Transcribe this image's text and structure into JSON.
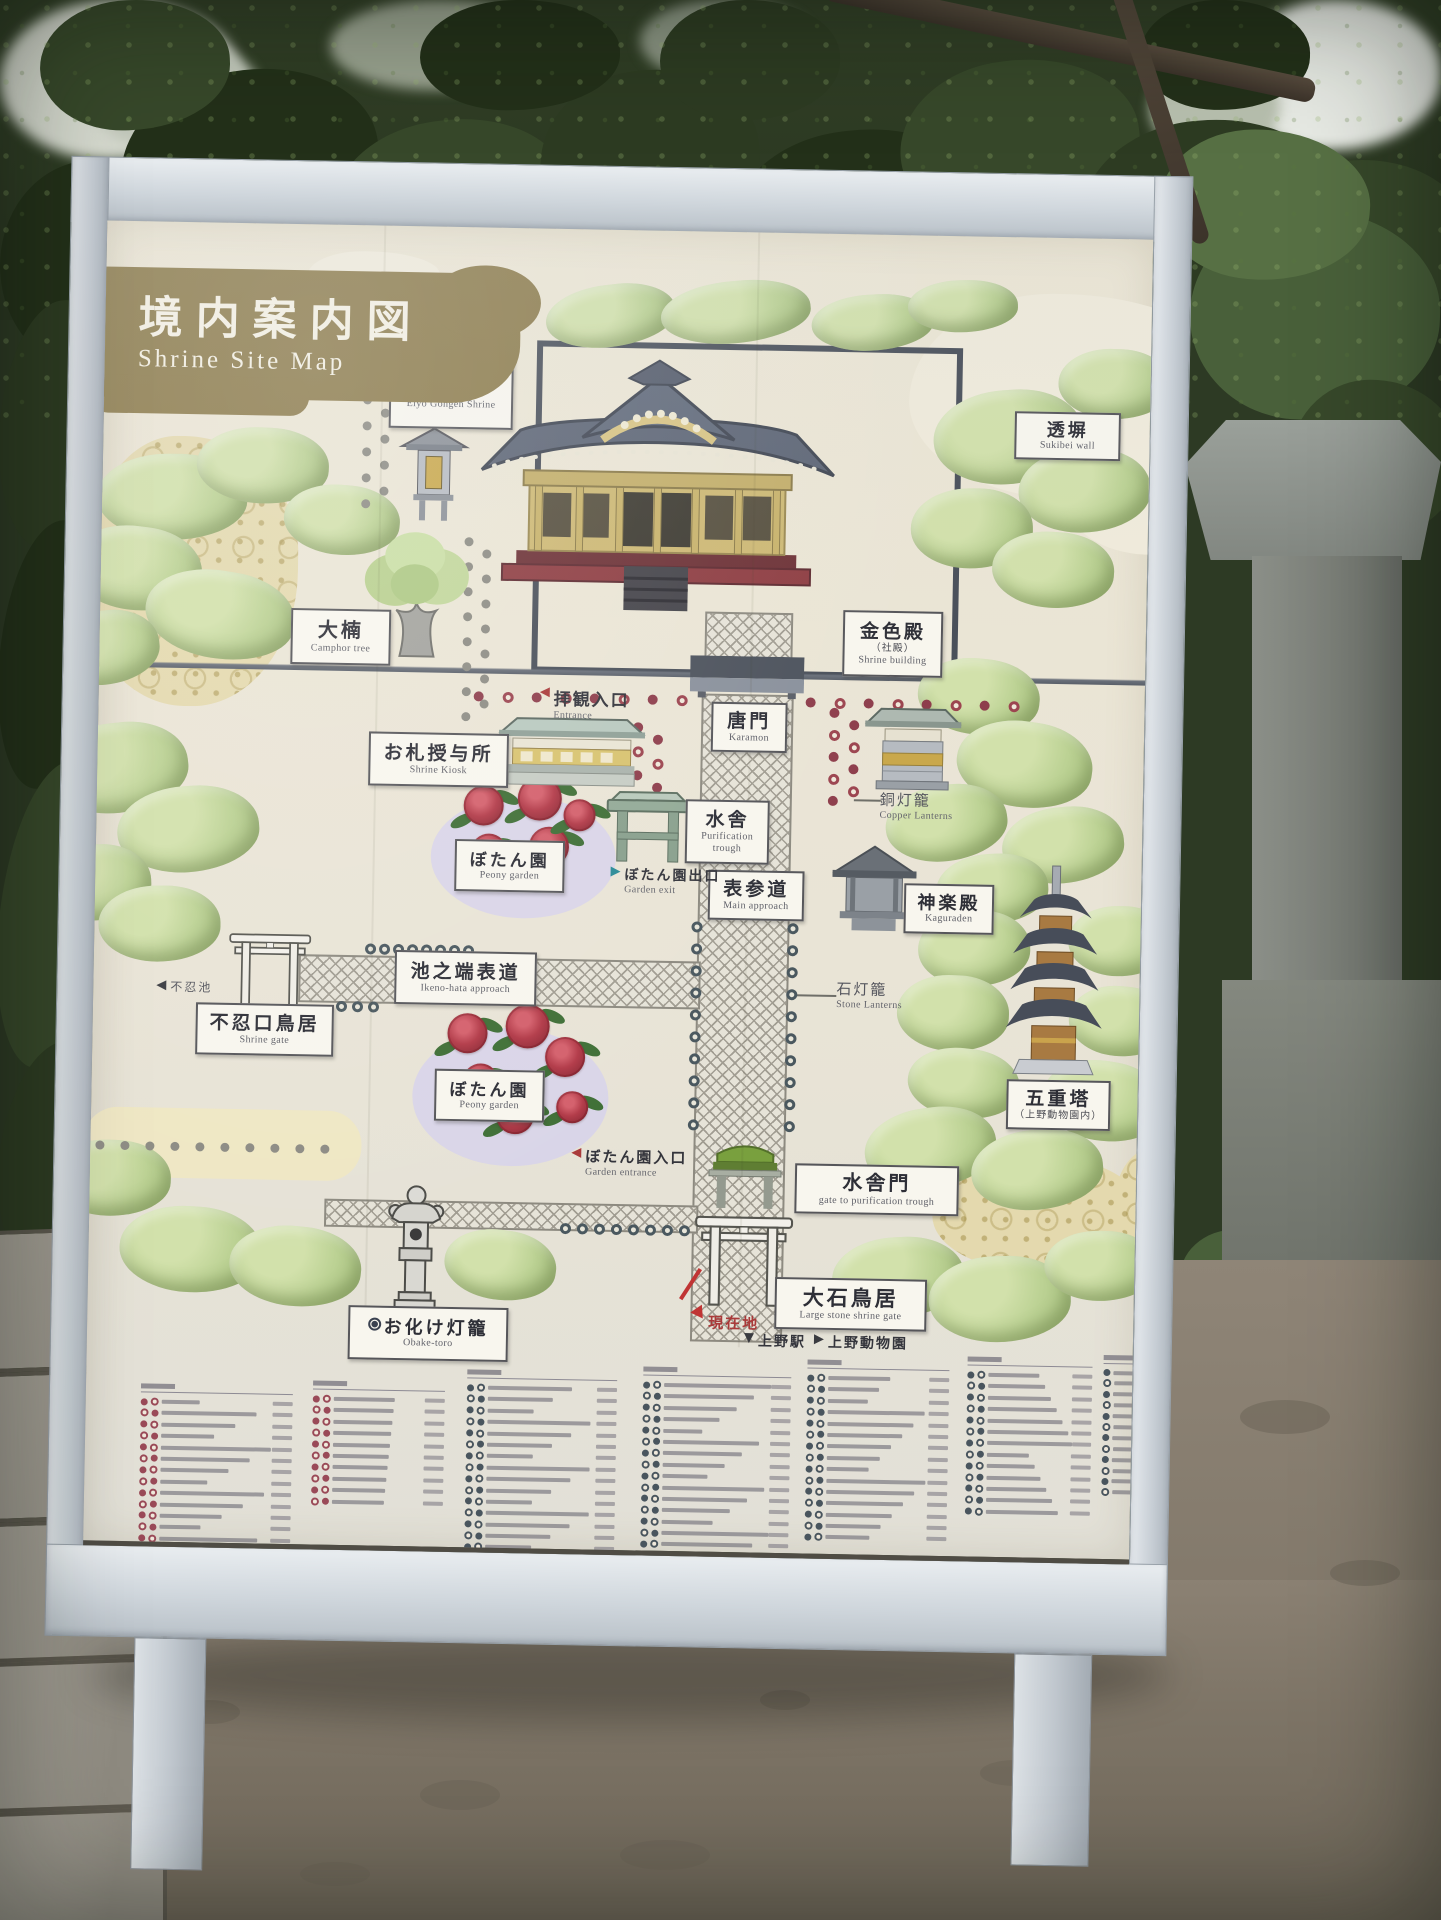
{
  "title": {
    "ja": "境内案内図",
    "en": "Shrine Site Map"
  },
  "side_sign": {
    "text": "上野東照宮",
    "mon": "tokugawa-aoi-crest"
  },
  "labels": [
    {
      "id": "eiyo-gongen-shrine",
      "ja": "栄誉権現社",
      "ja2": "（お狸様）",
      "en": "Eiyo Gongen Shrine",
      "x": 380,
      "y": 354,
      "w": 124,
      "h": 78,
      "fs": 16
    },
    {
      "id": "sukibei-wall",
      "ja": "透塀",
      "en": "Sukibei wall",
      "x": 1006,
      "y": 404,
      "w": 106,
      "h": 48,
      "fs": 18
    },
    {
      "id": "konjikiden",
      "ja": "金色殿",
      "ja2": "（社殿）",
      "en": "Shrine building",
      "x": 838,
      "y": 606,
      "w": 100,
      "h": 66,
      "fs": 19
    },
    {
      "id": "camphor-tree",
      "ja": "大楠",
      "en": "Camphor tree",
      "x": 286,
      "y": 614,
      "w": 100,
      "h": 56,
      "fs": 20
    },
    {
      "id": "shrine-kiosk",
      "ja": "お札授与所",
      "en": "Shrine Kiosk",
      "x": 366,
      "y": 736,
      "w": 140,
      "h": 54,
      "fs": 19
    },
    {
      "id": "karamon",
      "ja": "唐門",
      "en": "Karamon",
      "x": 708,
      "y": 700,
      "w": 76,
      "h": 50,
      "fs": 19
    },
    {
      "id": "mizuya",
      "ja": "水舎",
      "en": "Purification trough",
      "x": 684,
      "y": 798,
      "w": 84,
      "h": 64,
      "fs": 19
    },
    {
      "id": "peony-garden-upper",
      "ja": "ぼたん園",
      "en": "Peony garden",
      "x": 454,
      "y": 842,
      "w": 110,
      "h": 52,
      "fs": 17
    },
    {
      "id": "omotesando",
      "ja": "表参道",
      "en": "Main approach",
      "x": 708,
      "y": 868,
      "w": 96,
      "h": 50,
      "fs": 19
    },
    {
      "id": "kaguraden",
      "ja": "神楽殿",
      "en": "Kaguraden",
      "x": 904,
      "y": 878,
      "w": 90,
      "h": 50,
      "fs": 18
    },
    {
      "id": "ikenohata-approach",
      "ja": "池之端表道",
      "en": "Ikeno-hata approach",
      "x": 396,
      "y": 954,
      "w": 142,
      "h": 54,
      "fs": 19
    },
    {
      "id": "shinobazu-torii",
      "ja": "不忍口鳥居",
      "en": "Shrine gate",
      "x": 198,
      "y": 1010,
      "w": 138,
      "h": 52,
      "fs": 19
    },
    {
      "id": "peony-garden-lower",
      "ja": "ぼたん園",
      "en": "Peony garden",
      "x": 438,
      "y": 1072,
      "w": 110,
      "h": 52,
      "fs": 17
    },
    {
      "id": "five-story-pagoda",
      "ja": "五重塔",
      "ja2": "（上野動物園内）",
      "x": 1010,
      "y": 1072,
      "w": 104,
      "h": 50,
      "fs": 19
    },
    {
      "id": "mizuyamon",
      "ja": "水舎門",
      "en": "gate to purification trough",
      "x": 800,
      "y": 1160,
      "w": 164,
      "h": 50,
      "fs": 20
    },
    {
      "id": "oishi-torii",
      "ja": "大石鳥居",
      "en": "Large stone shrine gate",
      "x": 782,
      "y": 1274,
      "w": 152,
      "h": 52,
      "fs": 21
    },
    {
      "id": "obake-toro",
      "ja": "お化け灯籠",
      "en": "Obake-toro",
      "icon": true,
      "x": 356,
      "y": 1310,
      "w": 160,
      "h": 54,
      "fs": 18
    }
  ],
  "notes": [
    {
      "id": "entrance",
      "arrow": "◀",
      "ac": "red",
      "ja": "拝観入口",
      "en": "Entrance",
      "x": 536,
      "y": 686,
      "fs": 17
    },
    {
      "id": "garden-exit",
      "arrow": "▶",
      "ac": "teal",
      "ja": "ぼたん園出口",
      "en": "Garden exit",
      "x": 610,
      "y": 864,
      "fs": 14
    },
    {
      "id": "copper-lanterns",
      "ja": "銅灯籠",
      "en": "Copper Lanterns",
      "x": 878,
      "y": 784,
      "fs": 15,
      "muted": true
    },
    {
      "id": "stone-lanterns",
      "ja": "石灯籠",
      "en": "Stone Lanterns",
      "x": 838,
      "y": 974,
      "fs": 15,
      "muted": true
    },
    {
      "id": "shinobazu-pond",
      "arrow": "◀",
      "ac": "dark",
      "ja": "不忍池",
      "x": 158,
      "y": 986,
      "fs": 12,
      "muted": true
    },
    {
      "id": "garden-entrance",
      "arrow": "◀",
      "ac": "red",
      "ja": "ぼたん園入口",
      "en": "Garden entrance",
      "x": 576,
      "y": 1146,
      "fs": 15
    },
    {
      "id": "current-location",
      "ja": "現在地",
      "x": 716,
      "y": 1310,
      "fs": 15,
      "red": true
    },
    {
      "id": "ueno-station",
      "arrow": "▼",
      "ac": "dark",
      "ja": "上野駅",
      "x": 752,
      "y": 1328,
      "fs": 14
    },
    {
      "id": "ueno-zoo",
      "arrow": "▶",
      "ac": "dark",
      "ja": "上野動物園",
      "x": 822,
      "y": 1328,
      "fs": 14
    }
  ],
  "marker": {
    "slash": {
      "x": 688,
      "y": 1296,
      "len": 36,
      "ang": -58
    },
    "tri": {
      "x": 700,
      "y": 1306
    }
  },
  "map": {
    "enclosure": {
      "x": 527,
      "y": 342,
      "w": 426,
      "h": 332
    },
    "walls": [
      {
        "x": 95,
        "y": 670,
        "w": 594
      },
      {
        "x": 798,
        "y": 670,
        "w": 343
      }
    ],
    "paths": [
      {
        "x": 700,
        "y": 610,
        "w": 88,
        "h": 48
      },
      {
        "x": 698,
        "y": 692,
        "w": 92,
        "h": 648
      },
      {
        "x": 300,
        "y": 960,
        "w": 402,
        "h": 48
      },
      {
        "x": 330,
        "y": 1204,
        "w": 374,
        "h": 28
      }
    ],
    "leaders": [
      {
        "x": 948,
        "y": 428,
        "len": 58,
        "ang": 0
      },
      {
        "x": 852,
        "y": 795,
        "len": 27,
        "ang": 0
      },
      {
        "x": 796,
        "y": 991,
        "len": 42,
        "ang": 0
      }
    ],
    "dotruns": [
      {
        "x": 354,
        "y": 400,
        "dx": 0,
        "dy": 26,
        "n": 5,
        "s": "gray"
      },
      {
        "x": 372,
        "y": 413,
        "dx": 0,
        "dy": 26,
        "n": 4,
        "s": "gray"
      },
      {
        "x": 458,
        "y": 540,
        "dx": 0,
        "dy": 25,
        "n": 8,
        "s": "gray"
      },
      {
        "x": 476,
        "y": 552,
        "dx": 0,
        "dy": 25,
        "n": 7,
        "s": "gray"
      },
      {
        "x": 470,
        "y": 694,
        "dx": 29,
        "dy": 0,
        "n": 8,
        "s": "redalt"
      },
      {
        "x": 802,
        "y": 694,
        "dx": 29,
        "dy": 0,
        "n": 8,
        "s": "redalt"
      },
      {
        "x": 630,
        "y": 722,
        "dx": 0,
        "dy": 24,
        "n": 4,
        "s": "redalt"
      },
      {
        "x": 650,
        "y": 734,
        "dx": 0,
        "dy": 24,
        "n": 3,
        "s": "redalt"
      },
      {
        "x": 826,
        "y": 704,
        "dx": 0,
        "dy": 22,
        "n": 5,
        "s": "redalt"
      },
      {
        "x": 846,
        "y": 716,
        "dx": 0,
        "dy": 22,
        "n": 4,
        "s": "redalt"
      },
      {
        "x": 692,
        "y": 920,
        "dx": 0,
        "dy": 22,
        "n": 10,
        "s": "darkring"
      },
      {
        "x": 788,
        "y": 920,
        "dx": 0,
        "dy": 22,
        "n": 10,
        "s": "darkring"
      },
      {
        "x": 366,
        "y": 948,
        "dx": 14,
        "dy": 0,
        "n": 8,
        "s": "darkring"
      },
      {
        "x": 338,
        "y": 1006,
        "dx": 16,
        "dy": 0,
        "n": 3,
        "s": "darkring"
      },
      {
        "x": 566,
        "y": 1224,
        "dx": 17,
        "dy": 0,
        "n": 8,
        "s": "darkring"
      },
      {
        "x": 100,
        "y": 1150,
        "dx": 25,
        "dy": 0,
        "n": 10,
        "s": "gray"
      }
    ],
    "clouds": [
      {
        "x": 900,
        "y": 286,
        "w": 330,
        "h": 205,
        "v": "pale"
      },
      {
        "x": 1058,
        "y": 425,
        "w": 170,
        "h": 120,
        "v": "pale"
      },
      {
        "x": 296,
        "y": 256,
        "w": 132,
        "h": 48,
        "v": "pale"
      },
      {
        "x": 76,
        "y": 444,
        "w": 216,
        "h": 270,
        "v": "gold"
      },
      {
        "x": 938,
        "y": 1146,
        "w": 208,
        "h": 118,
        "v": "gold"
      },
      {
        "x": 1120,
        "y": 1138,
        "w": 88,
        "h": 104,
        "v": "gold"
      },
      {
        "x": 88,
        "y": 1116,
        "w": 278,
        "h": 70,
        "v": "cream"
      }
    ],
    "bushes": [
      [
        600,
        316,
        130,
        62
      ],
      [
        725,
        310,
        150,
        62
      ],
      [
        862,
        318,
        122,
        56
      ],
      [
        952,
        300,
        110,
        52
      ],
      [
        165,
        505,
        150,
        86
      ],
      [
        255,
        472,
        132,
        76
      ],
      [
        335,
        525,
        116,
        70
      ],
      [
        130,
        577,
        132,
        84
      ],
      [
        215,
        622,
        150,
        88
      ],
      [
        100,
        657,
        110,
        74
      ],
      [
        1000,
        430,
        150,
        94
      ],
      [
        1077,
        482,
        132,
        84
      ],
      [
        965,
        522,
        122,
        80
      ],
      [
        1105,
        375,
        112,
        70
      ],
      [
        1047,
        562,
        122,
        76
      ],
      [
        975,
        690,
        122,
        76
      ],
      [
        1022,
        757,
        136,
        86
      ],
      [
        945,
        817,
        122,
        76
      ],
      [
        1062,
        837,
        122,
        76
      ],
      [
        992,
        882,
        112,
        70
      ],
      [
        975,
        942,
        112,
        76
      ],
      [
        1120,
        932,
        102,
        70
      ],
      [
        955,
        1007,
        112,
        76
      ],
      [
        1122,
        1012,
        102,
        70
      ],
      [
        967,
        1077,
        112,
        70
      ],
      [
        1107,
        1092,
        122,
        80
      ],
      [
        115,
        777,
        142,
        90
      ],
      [
        187,
        837,
        142,
        86
      ],
      [
        95,
        892,
        112,
        76
      ],
      [
        160,
        932,
        122,
        76
      ],
      [
        115,
        1187,
        122,
        76
      ],
      [
        197,
        1257,
        142,
        86
      ],
      [
        302,
        1272,
        132,
        80
      ],
      [
        507,
        1267,
        112,
        70
      ],
      [
        935,
        1142,
        132,
        80
      ],
      [
        1042,
        1162,
        132,
        80
      ],
      [
        905,
        1272,
        132,
        80
      ],
      [
        1007,
        1292,
        142,
        86
      ],
      [
        1107,
        1257,
        112,
        70
      ]
    ],
    "gardens": [
      {
        "ex": 430,
        "ey": 798,
        "ew": 185,
        "eh": 122,
        "flowers": [
          [
            462,
            788,
            40
          ],
          [
            516,
            778,
            44
          ],
          [
            470,
            836,
            36
          ],
          [
            528,
            828,
            40
          ],
          [
            562,
            800,
            32
          ]
        ]
      },
      {
        "ex": 416,
        "ey": 1030,
        "ew": 196,
        "eh": 138,
        "flowers": [
          [
            450,
            1016,
            40
          ],
          [
            508,
            1006,
            44
          ],
          [
            466,
            1066,
            36
          ],
          [
            548,
            1038,
            40
          ],
          [
            500,
            1098,
            38
          ],
          [
            560,
            1092,
            32
          ]
        ]
      }
    ],
    "illustrations": [
      {
        "type": "shrine",
        "name": "main-shrine-building",
        "x": 470,
        "y": 352,
        "w": 360,
        "h": 270
      },
      {
        "type": "lantern",
        "name": "eiyo-gongen-lantern",
        "x": 388,
        "y": 428,
        "w": 76,
        "h": 100
      },
      {
        "type": "tree",
        "name": "camphor-tree-illustration",
        "x": 350,
        "y": 522,
        "w": 122,
        "h": 140
      },
      {
        "type": "kiosk",
        "name": "shrine-kiosk-building",
        "x": 494,
        "y": 712,
        "w": 150,
        "h": 80
      },
      {
        "type": "kiosk2",
        "name": "copper-lantern-stand",
        "x": 860,
        "y": 698,
        "w": 100,
        "h": 95
      },
      {
        "type": "karamon",
        "name": "karamon-gate",
        "x": 686,
        "y": 654,
        "w": 114,
        "h": 42
      },
      {
        "type": "mizuya",
        "name": "purification-trough",
        "x": 604,
        "y": 788,
        "w": 85,
        "h": 78
      },
      {
        "type": "kagura",
        "name": "kaguraden-building",
        "x": 832,
        "y": 838,
        "w": 84,
        "h": 96
      },
      {
        "type": "pagoda",
        "name": "five-story-pagoda-illustration",
        "x": 1000,
        "y": 854,
        "w": 112,
        "h": 218
      },
      {
        "type": "torii",
        "name": "shinobazu-torii-gate",
        "x": 224,
        "y": 936,
        "w": 94,
        "h": 80
      },
      {
        "type": "mizuyamon",
        "name": "mizuya-gate",
        "x": 708,
        "y": 1134,
        "w": 84,
        "h": 74
      },
      {
        "type": "torii",
        "name": "oishi-torii-gate",
        "x": 700,
        "y": 1208,
        "w": 100,
        "h": 98
      },
      {
        "type": "obake",
        "name": "obake-lantern-illustration",
        "x": 390,
        "y": 1188,
        "w": 64,
        "h": 128
      }
    ],
    "seams": [
      372,
      746
    ]
  },
  "legend": {
    "text_illegible": true,
    "groups": [
      {
        "x": 150,
        "y": 1392,
        "w": 152,
        "rows": 19,
        "c": "red",
        "cols": 2
      },
      {
        "x": 322,
        "y": 1386,
        "w": 132,
        "rows": 10,
        "c": "red",
        "cols": 2
      },
      {
        "x": 476,
        "y": 1372,
        "w": 150,
        "rows": 16,
        "c": "dark",
        "cols": 2
      },
      {
        "x": 652,
        "y": 1366,
        "w": 148,
        "rows": 17,
        "c": "dark",
        "cols": 2
      },
      {
        "x": 816,
        "y": 1356,
        "w": 142,
        "rows": 15,
        "c": "dark",
        "cols": 2
      },
      {
        "x": 976,
        "y": 1350,
        "w": 125,
        "rows": 13,
        "c": "dark",
        "cols": 2
      },
      {
        "x": 1112,
        "y": 1346,
        "w": 44,
        "rows": 12,
        "c": "dark",
        "cols": 1
      }
    ]
  },
  "scene": {
    "sky": [
      [
        0,
        0,
        240,
        160,
        "#d6dacf"
      ],
      [
        90,
        40,
        170,
        110,
        "#c2c8bb"
      ],
      [
        330,
        0,
        230,
        90,
        "#99a28f"
      ],
      [
        640,
        0,
        170,
        80,
        "#8a9482"
      ],
      [
        1236,
        0,
        205,
        150,
        "#e7eae4"
      ],
      [
        1150,
        60,
        130,
        95,
        "#b7bfae"
      ]
    ],
    "foliage": [
      [
        120,
        70,
        260,
        190,
        0
      ],
      [
        330,
        120,
        240,
        170,
        2
      ],
      [
        540,
        70,
        220,
        180,
        1
      ],
      [
        730,
        130,
        260,
        180,
        0
      ],
      [
        900,
        60,
        240,
        170,
        2
      ],
      [
        1080,
        120,
        260,
        190,
        1
      ],
      [
        1250,
        160,
        220,
        170,
        2
      ],
      [
        0,
        160,
        200,
        210,
        0
      ],
      [
        40,
        0,
        190,
        130,
        2
      ],
      [
        420,
        0,
        200,
        110,
        0
      ],
      [
        660,
        0,
        180,
        120,
        1
      ],
      [
        1140,
        0,
        170,
        110,
        0
      ],
      [
        1190,
        210,
        250,
        210,
        3
      ],
      [
        1290,
        380,
        170,
        160,
        2
      ],
      [
        1160,
        130,
        210,
        150,
        4
      ],
      [
        0,
        300,
        120,
        250,
        1
      ],
      [
        0,
        520,
        110,
        270,
        0
      ],
      [
        0,
        760,
        120,
        310,
        2
      ],
      [
        0,
        1040,
        120,
        230,
        1
      ],
      [
        1180,
        1230,
        130,
        100,
        3
      ]
    ],
    "foliage_palette": [
      "#233019",
      "#2d3b22",
      "#37482a",
      "#49603a",
      "#577044"
    ],
    "pebbles": [
      [
        180,
        1700,
        60,
        24
      ],
      [
        420,
        1780,
        80,
        30
      ],
      [
        760,
        1690,
        50,
        20
      ],
      [
        980,
        1760,
        70,
        26
      ],
      [
        1240,
        1400,
        90,
        34
      ],
      [
        1330,
        1560,
        70,
        26
      ],
      [
        620,
        1840,
        90,
        30
      ],
      [
        300,
        1862,
        70,
        24
      ]
    ],
    "wall_rows": [
      142,
      150,
      140,
      150,
      118
    ]
  }
}
